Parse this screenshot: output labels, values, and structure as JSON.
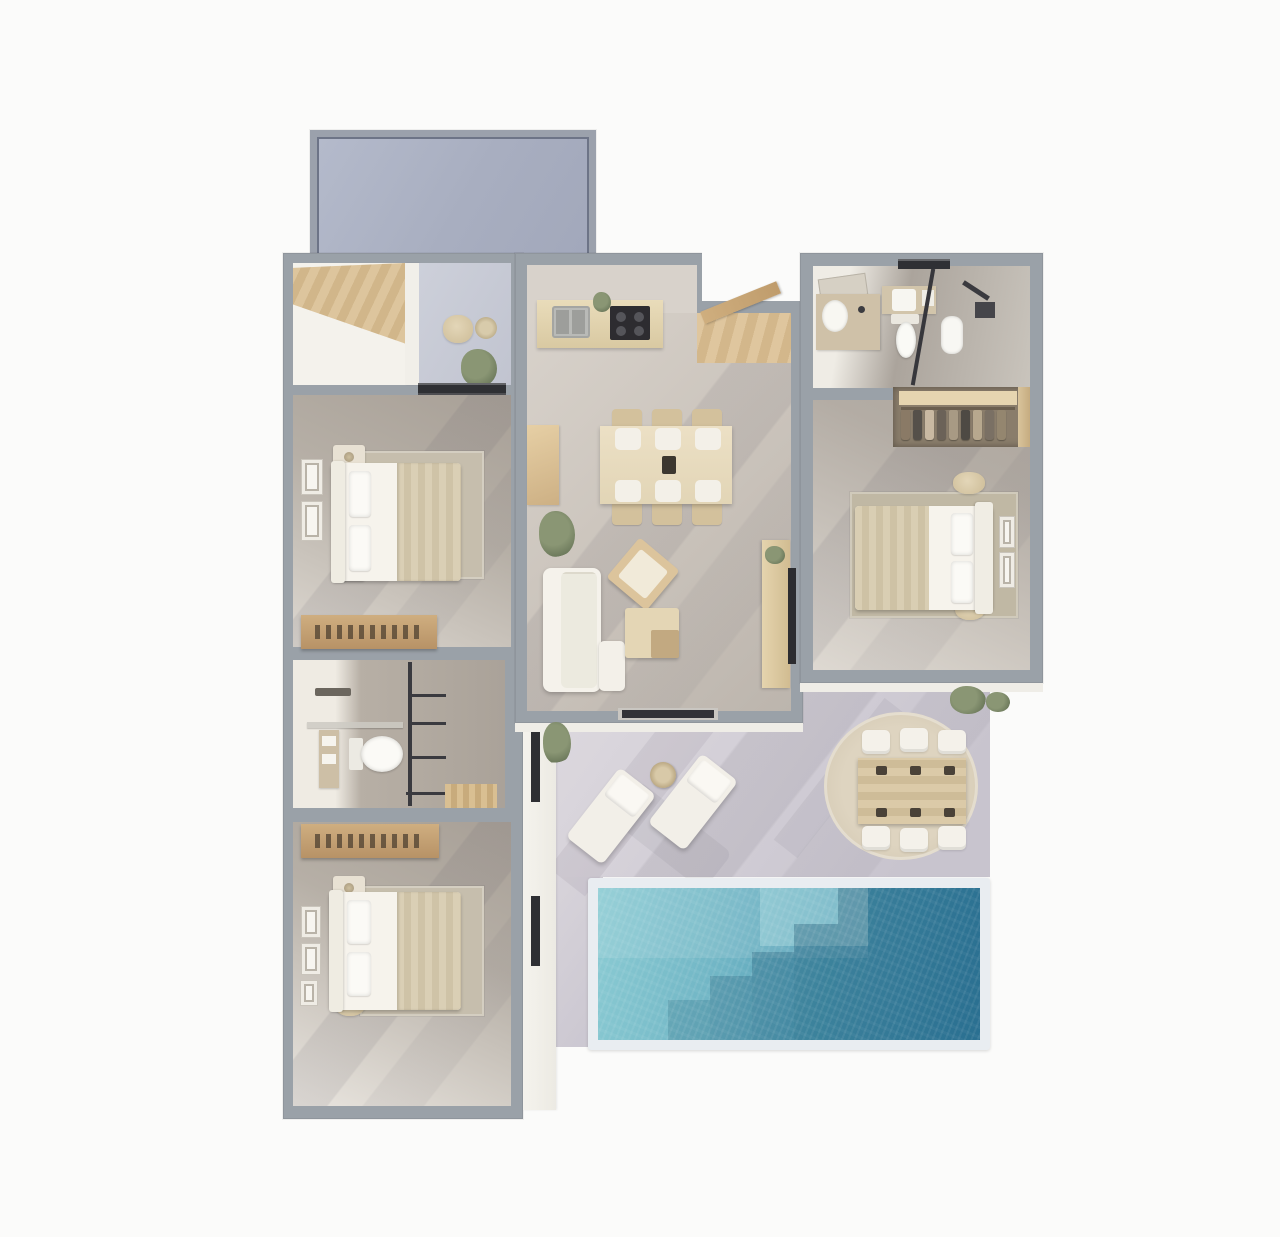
{
  "scene": {
    "kind": "3d-floor-plan-render",
    "view": "top-down",
    "description": "Photoreal 3D top view floor plan of a three-bedroom villa with kitchen-dining room, living area, two bathrooms, carport and pool terrace",
    "visible_text": ""
  },
  "palette": {
    "background": "#fbfbfa",
    "wall": "#9aa1a8",
    "interior_white": "#f4f2ec",
    "floor_warm": "#b4aca3",
    "floor_warm_light": "#e5e1da",
    "floor_main": "#cdc6be",
    "terrace": "#d6d2d8",
    "carport_fill": "#aab0c2",
    "carport_border": "#9ba1ac",
    "carport_line": "#6d7487",
    "wood": "#d8be96",
    "wood_dark": "#c2a379",
    "wood_light": "#e7dabb",
    "white_furniture": "#f4f1ea",
    "textile_beige": "#d6cbb0",
    "rug_beige": "#c6bead",
    "rug_jute": "#d9cfba",
    "dark_glass": "#303136",
    "pool_coping": "#e9edf1",
    "pool_light": "#8bcbd3",
    "pool_dark": "#31809f",
    "plant": "#8a9674",
    "plant_dark": "#6d7a5c"
  },
  "rooms": [
    {
      "id": "carport",
      "name": "carport"
    },
    {
      "id": "storage-room",
      "name": "storage"
    },
    {
      "id": "entry-porch",
      "name": "entry porch"
    },
    {
      "id": "bedroom-1",
      "name": "bedroom 1"
    },
    {
      "id": "bathroom-1",
      "name": "bathroom 1"
    },
    {
      "id": "bedroom-2",
      "name": "bedroom 2"
    },
    {
      "id": "kitchen-dining",
      "name": "kitchen / dining room"
    },
    {
      "id": "living-area",
      "name": "living area"
    },
    {
      "id": "bathroom-2",
      "name": "bathroom 2"
    },
    {
      "id": "bedroom-3",
      "name": "bedroom 3"
    },
    {
      "id": "wardrobe",
      "name": "wardrobe"
    },
    {
      "id": "terrace",
      "name": "pool terrace"
    },
    {
      "id": "pool",
      "name": "swimming pool"
    }
  ],
  "furniture_counts": {
    "beds": 3,
    "dining_chairs": 6,
    "outdoor_dining_chairs": 6,
    "sun_loungers": 2,
    "toilets": 2,
    "sofas": 1
  },
  "wardrobe_clothes_colors": [
    "#8a7a66",
    "#55504a",
    "#c9b9a2",
    "#6b6258",
    "#a89a84",
    "#4e4a44",
    "#b7a88e",
    "#7a7064",
    "#94866f"
  ]
}
